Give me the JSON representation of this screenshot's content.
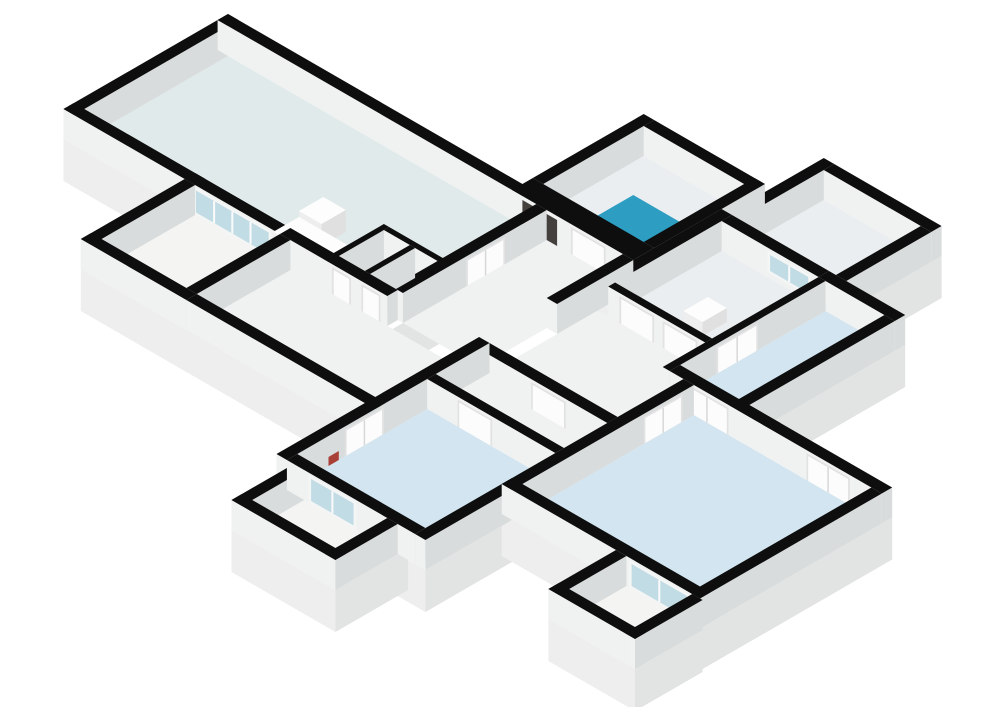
{
  "page": {
    "background": "#ffffff",
    "description": "3D isometric floor plan rendering of an apartment, no text labels"
  },
  "floorplan": {
    "iso": {
      "ox": 228,
      "oy": 44,
      "wall_height": 30,
      "plinth_depth": 42,
      "cos": 0.866,
      "sin": 0.5
    },
    "colors": {
      "cap": "#0e0e0e",
      "wall_face_sw": "#f0f1f1",
      "wall_face_se": "#d9dcdc",
      "plinth_sw": "#eeeeee",
      "plinth_se": "#e2e3e3",
      "floor_living": "#e0eaea",
      "floor_bedroom": "#d2e5f0",
      "floor_hall": "#f0f2f2",
      "floor_balcony": "#f4f4f3",
      "floor_white": "#eaeef0",
      "shower_tray": "#2d9dc2",
      "shower_tray_edge": "#1d81a6",
      "door_leaf": "#fcfcfc",
      "door_frame": "#e2e2e2",
      "glass": "#c2dce5",
      "glass_frame": "#f4f5f5",
      "dark_closet": "#44403d",
      "dark_closet_box": "#6f4e3d",
      "red_item": "#a84038",
      "fixture_top": "#fdfdfd",
      "fixture_sw": "#eeeeee",
      "fixture_se": "#e0e0e0"
    },
    "plinths": [
      [
        0,
        380,
        0,
        190
      ],
      [
        340,
        480,
        -140,
        12
      ],
      [
        488,
        624,
        -200,
        -90
      ],
      [
        480,
        692,
        -90,
        102
      ],
      [
        628,
        857,
        90,
        312
      ],
      [
        760,
        860,
        312,
        390
      ],
      [
        468,
        640,
        178,
        412
      ],
      [
        250,
        480,
        178,
        310
      ],
      [
        140,
        262,
        178,
        310
      ],
      [
        488,
        608,
        400,
        484
      ]
    ],
    "floors": [
      {
        "r": [
          12,
          368,
          12,
          178
        ],
        "c": "floor_living",
        "n": "living-room-floor"
      },
      {
        "r": [
          306,
          336,
          126,
          178
        ],
        "c": "floor_white",
        "n": "closet-a-floor"
      },
      {
        "r": [
          342,
          368,
          126,
          178
        ],
        "c": "floor_white",
        "n": "closet-b-floor"
      },
      {
        "r": [
          352,
          468,
          -128,
          -12
        ],
        "c": "floor_white",
        "n": "shower-room-floor"
      },
      {
        "r": [
          500,
          612,
          -188,
          -90
        ],
        "c": "floor_white",
        "n": "storage-room-floor"
      },
      {
        "r": [
          492,
          604,
          -78,
          45
        ],
        "c": "floor_white",
        "n": "washroom-floor"
      },
      {
        "r": [
          612,
          680,
          -78,
          90
        ],
        "c": "floor_bedroom",
        "n": "bedroom-3-floor"
      },
      {
        "r": [
          380,
          468,
          12,
          178
        ],
        "c": "floor_hall",
        "n": "hallway-floor"
      },
      {
        "r": [
          480,
          604,
          53,
          178
        ],
        "c": "floor_hall",
        "n": "hall-2-floor"
      },
      {
        "r": [
          604,
          628,
          102,
          190
        ],
        "c": "floor_hall",
        "n": "hall-patch-floor"
      },
      {
        "r": [
          152,
          250,
          190,
          298
        ],
        "c": "floor_balcony",
        "n": "balcony-top-left-floor"
      },
      {
        "r": [
          262,
          468,
          190,
          298
        ],
        "c": "floor_hall",
        "n": "long-room-floor"
      },
      {
        "r": [
          480,
          628,
          190,
          240
        ],
        "c": "floor_hall",
        "n": "corridor-2-floor"
      },
      {
        "r": [
          480,
          628,
          250,
          400
        ],
        "c": "floor_bedroom",
        "n": "bedroom-2-floor"
      },
      {
        "r": [
          640,
          845,
          102,
          300
        ],
        "c": "floor_bedroom",
        "n": "bedroom-1-floor"
      },
      {
        "r": [
          772,
          848,
          312,
          378
        ],
        "c": "floor_balcony",
        "n": "balcony-bottom-right-floor"
      },
      {
        "r": [
          500,
          596,
          412,
          472
        ],
        "c": "floor_balcony",
        "n": "balcony-bottom-left-floor"
      }
    ],
    "walls": [
      {
        "r": [
          0,
          352,
          0,
          12
        ],
        "n": "living-ne-wall"
      },
      {
        "r": [
          0,
          12,
          0,
          190
        ],
        "n": "living-nw-wall"
      },
      {
        "r": [
          0,
          152,
          178,
          190
        ],
        "n": "living-sw-wall"
      },
      {
        "r": [
          140,
          250,
          178,
          190
        ],
        "n": "living-balcony-wall",
        "d": [
          {
            "t": "glass4",
            "s": "y",
            "a": 150,
            "b": 240,
            "n": "french-doors"
          }
        ]
      },
      {
        "r": [
          250,
          374,
          178,
          190
        ],
        "n": "closet-front-wall",
        "d": [
          {
            "t": "door",
            "s": "y",
            "a": 310,
            "b": 332,
            "n": "closet-a-door"
          },
          {
            "t": "door",
            "s": "y",
            "a": 344,
            "b": 366,
            "n": "closet-b-door"
          }
        ]
      },
      {
        "r": [
          140,
          152,
          190,
          310
        ],
        "n": "balcony-tl-w-wall"
      },
      {
        "r": [
          140,
          262,
          298,
          310
        ],
        "n": "balcony-tl-s-wall"
      },
      {
        "r": [
          250,
          262,
          190,
          298
        ],
        "n": "balcony-tl-divider"
      },
      {
        "r": [
          262,
          480,
          298,
          310
        ],
        "n": "long-room-s-wall"
      },
      {
        "r": [
          368,
          380,
          12,
          178
        ],
        "n": "living-hall-wall",
        "d": [
          {
            "t": "door",
            "s": "x",
            "a": 60,
            "b": 105,
            "n": "living-door"
          }
        ]
      },
      {
        "r": [
          340,
          480,
          -12,
          12
        ],
        "n": "shower-sw-wall",
        "d": [
          {
            "t": "dark",
            "s": "y",
            "a": 352,
            "b": 392,
            "n": "tech-closet"
          },
          {
            "t": "door",
            "s": "y",
            "a": 408,
            "b": 448,
            "n": "shower-door"
          }
        ]
      },
      {
        "r": [
          340,
          352,
          -140,
          -12
        ],
        "n": "shower-nw-wall"
      },
      {
        "r": [
          352,
          480,
          -140,
          -128
        ],
        "n": "shower-ne-wall"
      },
      {
        "r": [
          468,
          480,
          -140,
          -12
        ],
        "n": "shower-e-wall"
      },
      {
        "r": [
          480,
          492,
          -90,
          45
        ],
        "n": "washroom-w-wall"
      },
      {
        "r": [
          488,
          500,
          -200,
          -90
        ],
        "n": "storage-nw-wall"
      },
      {
        "r": [
          500,
          624,
          -200,
          -188
        ],
        "n": "storage-ne-wall"
      },
      {
        "r": [
          612,
          624,
          -188,
          -90
        ],
        "n": "storage-se-wall"
      },
      {
        "r": [
          492,
          604,
          -90,
          -78
        ],
        "n": "storage-sw-wall",
        "d": [
          {
            "t": "win",
            "s": "y",
            "a": 545,
            "b": 595,
            "n": "interior-window"
          }
        ]
      },
      {
        "r": [
          604,
          692,
          -90,
          -78
        ],
        "n": "bedroom3-ne-wall"
      },
      {
        "r": [
          680,
          692,
          -78,
          102
        ],
        "n": "bedroom3-e-wall"
      },
      {
        "r": [
          604,
          612,
          -78,
          102
        ],
        "n": "bedroom3-w-wall",
        "d": [
          {
            "t": "door",
            "s": "x",
            "a": 0,
            "b": 48,
            "n": "bedroom3-door"
          }
        ]
      },
      {
        "r": [
          492,
          604,
          45,
          53
        ],
        "n": "hall2-n-wall",
        "d": [
          {
            "t": "door",
            "s": "y",
            "a": 505,
            "b": 545,
            "n": "washroom-door-a"
          },
          {
            "t": "door",
            "s": "y",
            "a": 555,
            "b": 595,
            "n": "washroom-door-b"
          }
        ]
      },
      {
        "r": [
          612,
          728,
          90,
          102
        ],
        "n": "bedroom3-sw-wall",
        "d": [
          {
            "t": "door",
            "s": "y",
            "a": 630,
            "b": 680,
            "n": "bedroom3-s-door"
          }
        ]
      },
      {
        "r": [
          628,
          640,
          102,
          312
        ],
        "n": "bedroom1-w-wall",
        "d": [
          {
            "t": "door",
            "s": "x",
            "a": 115,
            "b": 160,
            "n": "bedroom1-door"
          }
        ]
      },
      {
        "r": [
          692,
          857,
          90,
          102
        ],
        "n": "bedroom1-ne-wall",
        "d": [
          {
            "t": "door",
            "s": "y",
            "a": 770,
            "b": 820,
            "n": "bedroom1-ne-door"
          }
        ]
      },
      {
        "r": [
          845,
          857,
          102,
          312
        ],
        "n": "bedroom1-e-wall"
      },
      {
        "r": [
          628,
          857,
          300,
          312
        ],
        "n": "bedroom1-sw-wall",
        "d": [
          {
            "t": "glass2",
            "s": "y",
            "a": 775,
            "b": 845,
            "n": "balcony-br-glass-door"
          }
        ]
      },
      {
        "r": [
          760,
          772,
          312,
          390
        ],
        "n": "balcony-br-w-wall"
      },
      {
        "r": [
          760,
          860,
          378,
          390
        ],
        "n": "balcony-br-s-wall"
      },
      {
        "r": [
          848,
          860,
          312,
          390
        ],
        "n": "balcony-br-e-wall"
      },
      {
        "r": [
          468,
          480,
          178,
          412
        ],
        "n": "west-spine-wall",
        "d": [
          {
            "t": "door",
            "s": "x",
            "a": 300,
            "b": 345,
            "n": "bedroom2-w-door"
          },
          {
            "t": "red",
            "s": "x",
            "a": 352,
            "b": 364,
            "n": "red-item"
          }
        ]
      },
      {
        "r": [
          480,
          628,
          240,
          250
        ],
        "n": "bedroom2-n-wall",
        "d": [
          {
            "t": "door",
            "s": "y",
            "a": 515,
            "b": 555,
            "n": "bedroom2-door"
          }
        ]
      },
      {
        "r": [
          480,
          628,
          400,
          412
        ],
        "n": "bedroom2-sw-wall",
        "d": [
          {
            "t": "glass2",
            "s": "y",
            "a": 505,
            "b": 560,
            "n": "balcony-bl-glass-door"
          }
        ]
      },
      {
        "r": [
          628,
          640,
          312,
          412
        ],
        "n": "bedroom2-e-wall"
      },
      {
        "r": [
          480,
          628,
          178,
          190
        ],
        "n": "corridor2-n-wall",
        "d": [
          {
            "t": "door",
            "s": "y",
            "a": 540,
            "b": 580,
            "n": "corridor2-door"
          }
        ]
      },
      {
        "r": [
          468,
          480,
          12,
          100
        ],
        "n": "hallway-e-wall"
      },
      {
        "r": [
          300,
          306,
          120,
          190
        ],
        "n": "closet-w-wall"
      },
      {
        "r": [
          306,
          374,
          120,
          126
        ],
        "n": "closet-n-wall"
      },
      {
        "r": [
          336,
          342,
          126,
          178
        ],
        "n": "closet-divider-wall"
      },
      {
        "r": [
          488,
          500,
          412,
          484
        ],
        "n": "balcony-bl-w-wall"
      },
      {
        "r": [
          488,
          608,
          472,
          484
        ],
        "n": "balcony-bl-s-wall"
      },
      {
        "r": [
          596,
          608,
          412,
          484
        ],
        "n": "balcony-bl-e-wall"
      }
    ],
    "fixtures": [
      {
        "t": "tray",
        "r": [
          388,
          448,
          -80,
          -20
        ],
        "h": 3,
        "n": "shower-tray"
      },
      {
        "t": "box",
        "r": [
          230,
          300,
          148,
          178
        ],
        "h": 16,
        "n": "kitchen-counter"
      },
      {
        "t": "box",
        "r": [
          230,
          256,
          120,
          148
        ],
        "h": 22,
        "n": "kitchen-counter-block"
      },
      {
        "t": "box",
        "r": [
          544,
          566,
          -10,
          18
        ],
        "h": 14,
        "n": "wall-basin"
      }
    ]
  }
}
